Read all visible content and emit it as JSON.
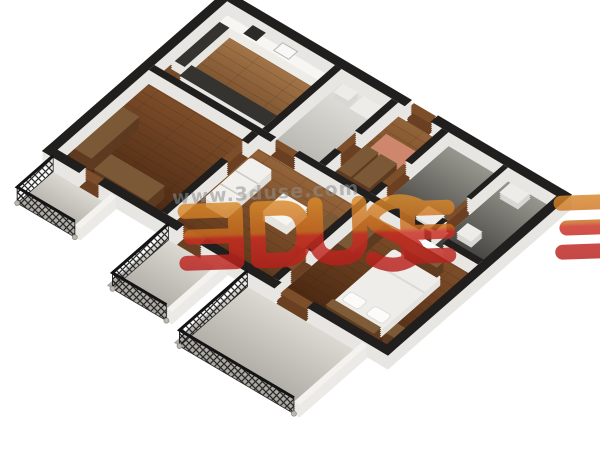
{
  "watermark": {
    "url_text": "www.3duse.com",
    "logo_text": "3DUSE"
  },
  "scene": {
    "type": "3d-apartment-floor-plan-render",
    "rooms": [
      "kitchen",
      "bathroom",
      "entry-hall",
      "storage-room-1",
      "storage-room-2",
      "living-room",
      "left-bedroom",
      "right-bedroom",
      "balcony-left",
      "balcony-middle",
      "balcony-front"
    ],
    "furniture": [
      "kitchen-cabinets",
      "countertop",
      "stove",
      "sink",
      "washer",
      "sofa",
      "coffee-table",
      "rug",
      "wardrobes",
      "tv-unit",
      "double-bed",
      "pillows",
      "bedside-table",
      "doors",
      "iron-railings"
    ]
  },
  "colors": {
    "background": "#ffffff",
    "wall_top": "#201f1e",
    "wall_side": "#e8e6e2",
    "wood_floor": "#7a4c28",
    "kitchen_tile_green": "#b5c7ac",
    "bath_tile": "#d9d8d2",
    "dark_tile": "#4e4d49",
    "balcony_floor": "#cfcdc6",
    "rug_salmon": "#d28a70",
    "furniture_white": "#f2f1ed",
    "furniture_wood": "#7b5836",
    "logo_orange": "#d8892b",
    "logo_red": "#c62721",
    "watermark_gray": "#909090"
  }
}
